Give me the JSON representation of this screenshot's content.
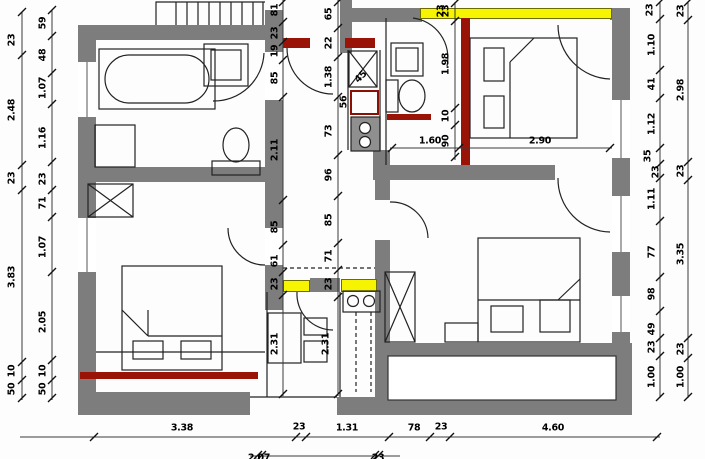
{
  "drawing": {
    "type": "architectural-floor-plan",
    "colors": {
      "wall_gray": "#7d7d7d",
      "highlight_yellow": "#f6f400",
      "highlight_red": "#991306",
      "line": "#222222",
      "background": "#ffffff"
    }
  },
  "dims": {
    "left_outer": [
      "23",
      "2.48",
      "23",
      "3.83",
      "10",
      "50"
    ],
    "left_inner": [
      "59",
      "48",
      "1.07",
      "1.16",
      "23",
      "71",
      "1.07",
      "2.05",
      "10",
      "50"
    ],
    "center_left": [
      "81",
      "23",
      "19",
      "85",
      "2.11",
      "85",
      "61",
      "23",
      "2.31"
    ],
    "center_right": [
      "65",
      "22",
      "1.38",
      "73",
      "96",
      "85",
      "71",
      "23",
      "2.31"
    ],
    "kitchen": [
      "45",
      "56"
    ],
    "bath_chain": [
      "23",
      "1.98",
      "10",
      "90"
    ],
    "widths_mid": [
      "1.60",
      "2.90"
    ],
    "right_inner": [
      "23",
      "1.10",
      "41",
      "1.12",
      "35",
      "23",
      "1.11",
      "77",
      "98",
      "49",
      "23",
      "1.00"
    ],
    "right_outer": [
      "23",
      "2.98",
      "23",
      "3.35",
      "23",
      "1.00"
    ],
    "bottom": [
      "3.38",
      "23",
      "1.31",
      "78",
      "23",
      "4.60"
    ],
    "bottom_partial": [
      "2.07",
      "23"
    ],
    "window_top": "23"
  }
}
